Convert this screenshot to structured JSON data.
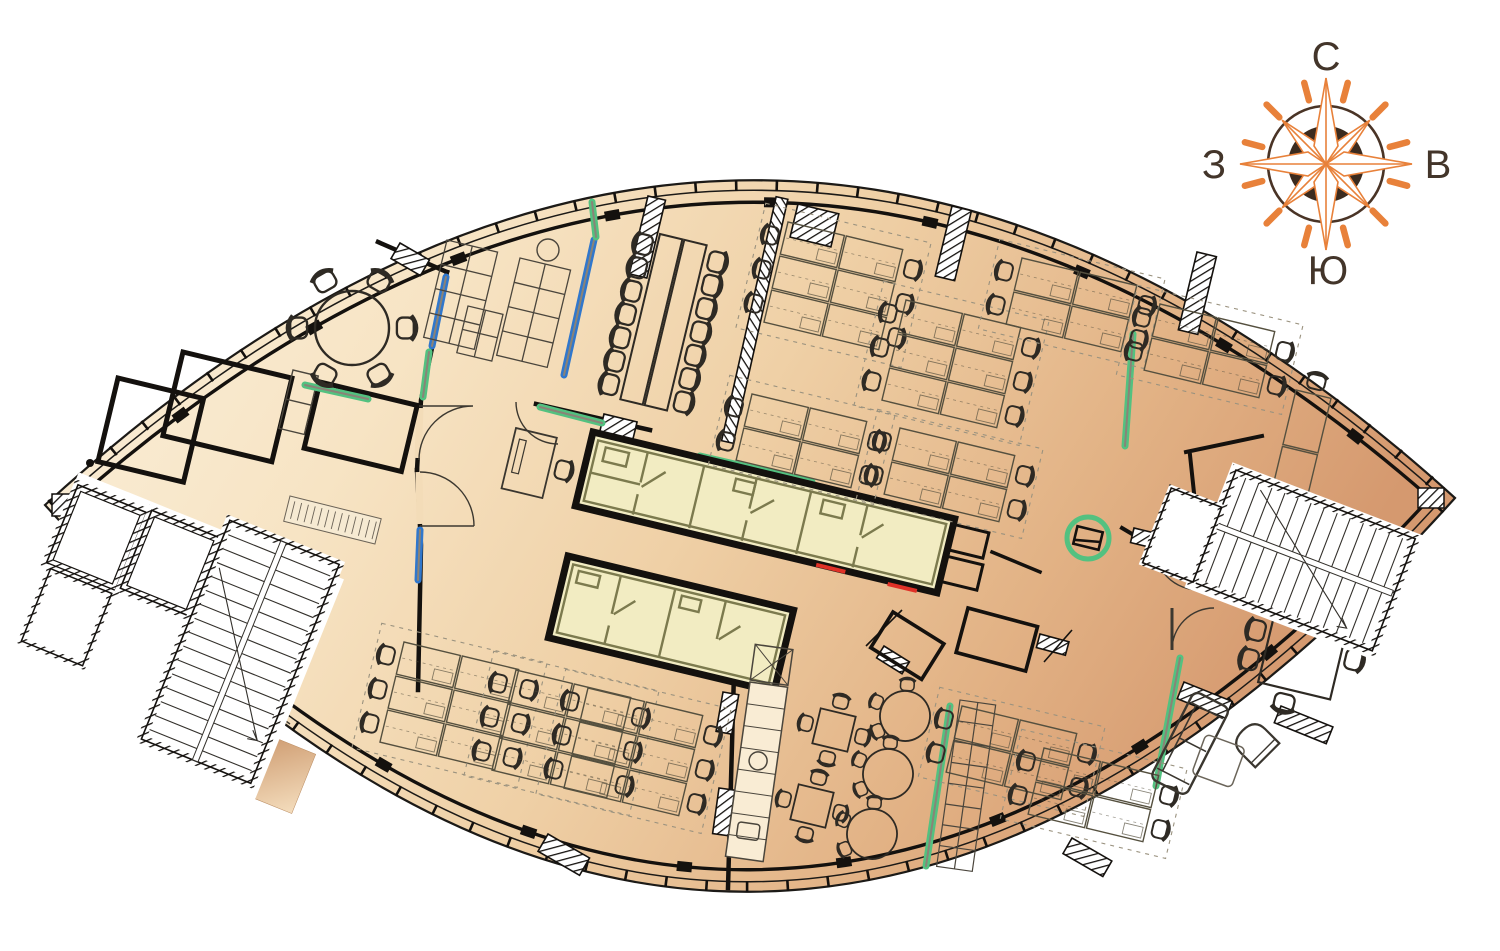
{
  "page": {
    "kind": "architectural-floor-plan",
    "building_shape": "lens-ellipse",
    "background": "#ffffff"
  },
  "compass": {
    "north_label": "С",
    "east_label": "В",
    "south_label": "Ю",
    "west_label": "З",
    "accent_color": "#e8813a",
    "hub_color": "#3b2b1f",
    "ring_color": "#4a3426",
    "label_color": "#43352a",
    "tick_count": 12
  },
  "palette": {
    "wall": "#14110e",
    "floor_gradient": [
      "#fbf0dc",
      "#f7e4c4",
      "#efd0a6",
      "#e2b285",
      "#d5996f"
    ],
    "sanitary_core_fill": "#f2ecc2",
    "sanitary_core_line": "#7c7a4e",
    "glass_green": "#53c180",
    "glass_blue": "#3077cc",
    "door_marker_red": "#e03127",
    "furniture_line": "#2e2a24",
    "light_line": "#9a927f"
  },
  "furniture_summary": {
    "conference_seats": 14,
    "round_meeting_table_seats": 6,
    "workstation_clusters": 12,
    "cafe_square_tables": 2,
    "cafe_round_tables": 3,
    "lounge_sofas": 1,
    "stair_cores": 2,
    "elevators": 2,
    "sanitary_core_blocks": 2
  }
}
